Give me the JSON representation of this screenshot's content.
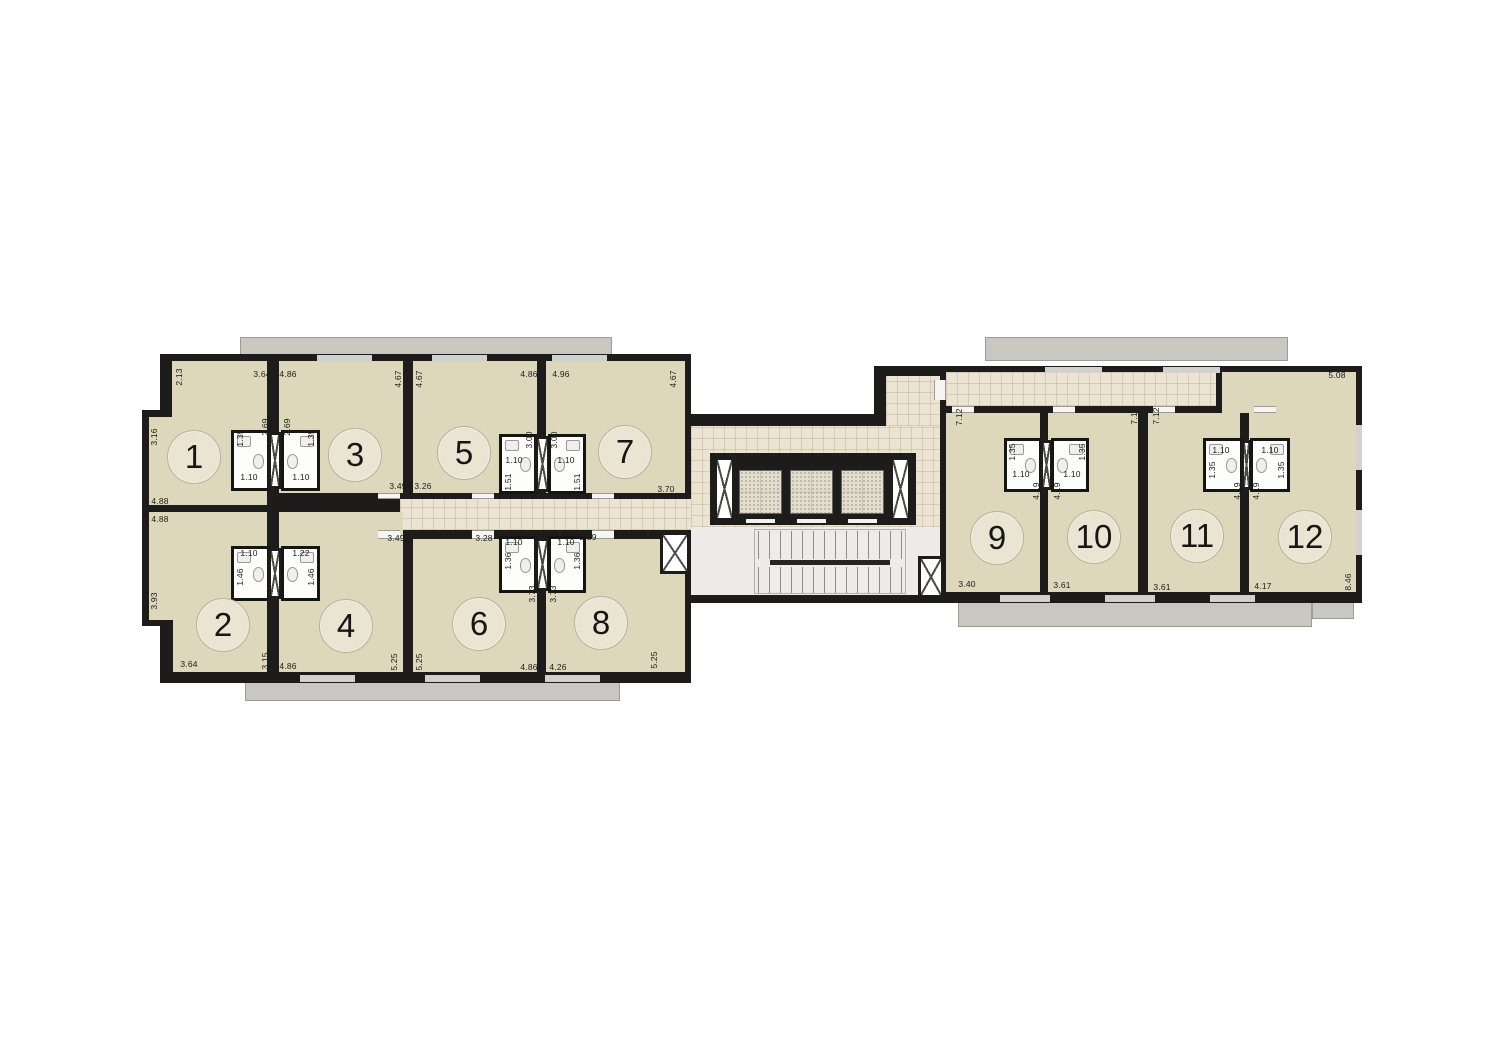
{
  "plan": {
    "name": "apartment-floor-plan",
    "colors": {
      "wall": "#1d1c1a",
      "room_fill": "#ddd7bc",
      "corridor_fill": "#ece4d3",
      "balcony_fill": "#c9c7c2",
      "stair_hall_fill": "#edecea",
      "bath_fill": "#fdfdfc",
      "background": "#ffffff"
    },
    "units": [
      {
        "n": "1",
        "x": 194,
        "y": 457
      },
      {
        "n": "2",
        "x": 223,
        "y": 625
      },
      {
        "n": "3",
        "x": 355,
        "y": 455
      },
      {
        "n": "4",
        "x": 346,
        "y": 626
      },
      {
        "n": "5",
        "x": 464,
        "y": 453
      },
      {
        "n": "6",
        "x": 479,
        "y": 624
      },
      {
        "n": "7",
        "x": 625,
        "y": 452
      },
      {
        "n": "8",
        "x": 601,
        "y": 623
      },
      {
        "n": "9",
        "x": 997,
        "y": 538
      },
      {
        "n": "10",
        "x": 1094,
        "y": 537
      },
      {
        "n": "11",
        "x": 1197,
        "y": 536
      },
      {
        "n": "12",
        "x": 1305,
        "y": 537
      }
    ],
    "dims": [
      {
        "t": "2.13",
        "x": 179,
        "y": 377,
        "v": 1
      },
      {
        "t": "3.64",
        "x": 262,
        "y": 374
      },
      {
        "t": "4.86",
        "x": 288,
        "y": 374
      },
      {
        "t": "4.67",
        "x": 398,
        "y": 379,
        "v": 1
      },
      {
        "t": "4.67",
        "x": 419,
        "y": 379,
        "v": 1
      },
      {
        "t": "4.86",
        "x": 529,
        "y": 374
      },
      {
        "t": "4.96",
        "x": 561,
        "y": 374
      },
      {
        "t": "4.67",
        "x": 673,
        "y": 379,
        "v": 1
      },
      {
        "t": "3.16",
        "x": 154,
        "y": 437,
        "v": 1
      },
      {
        "t": "4.88",
        "x": 160,
        "y": 501
      },
      {
        "t": "4.88",
        "x": 160,
        "y": 519
      },
      {
        "t": "3.93",
        "x": 154,
        "y": 601,
        "v": 1
      },
      {
        "t": "3.64",
        "x": 189,
        "y": 664
      },
      {
        "t": "3.15",
        "x": 265,
        "y": 661,
        "v": 1
      },
      {
        "t": "4.86",
        "x": 288,
        "y": 666
      },
      {
        "t": "5.25",
        "x": 394,
        "y": 662,
        "v": 1
      },
      {
        "t": "5.25",
        "x": 419,
        "y": 662,
        "v": 1
      },
      {
        "t": "4.86",
        "x": 529,
        "y": 667
      },
      {
        "t": "4.26",
        "x": 558,
        "y": 667
      },
      {
        "t": "5.25",
        "x": 654,
        "y": 660,
        "v": 1
      },
      {
        "t": "3.49",
        "x": 398,
        "y": 486
      },
      {
        "t": "3.26",
        "x": 423,
        "y": 486
      },
      {
        "t": "3.70",
        "x": 666,
        "y": 489
      },
      {
        "t": "3.49",
        "x": 396,
        "y": 538
      },
      {
        "t": "3.28",
        "x": 484,
        "y": 538
      },
      {
        "t": "2.89",
        "x": 588,
        "y": 537
      },
      {
        "t": "2.69",
        "x": 265,
        "y": 427,
        "v": 1
      },
      {
        "t": "2.69",
        "x": 287,
        "y": 427,
        "v": 1
      },
      {
        "t": "1.35",
        "x": 240,
        "y": 438,
        "v": 1
      },
      {
        "t": "1.10",
        "x": 249,
        "y": 477
      },
      {
        "t": "1.35",
        "x": 311,
        "y": 438,
        "v": 1
      },
      {
        "t": "1.10",
        "x": 301,
        "y": 477
      },
      {
        "t": "1.10",
        "x": 249,
        "y": 553
      },
      {
        "t": "1.46",
        "x": 240,
        "y": 577,
        "v": 1
      },
      {
        "t": "1.22",
        "x": 301,
        "y": 553
      },
      {
        "t": "1.46",
        "x": 311,
        "y": 577,
        "v": 1
      },
      {
        "t": "3.00",
        "x": 529,
        "y": 440,
        "v": 1
      },
      {
        "t": "3.00",
        "x": 554,
        "y": 440,
        "v": 1
      },
      {
        "t": "1.10",
        "x": 514,
        "y": 460
      },
      {
        "t": "1.51",
        "x": 508,
        "y": 482,
        "v": 1
      },
      {
        "t": "1.10",
        "x": 566,
        "y": 460
      },
      {
        "t": "1.51",
        "x": 577,
        "y": 482,
        "v": 1
      },
      {
        "t": "1.10",
        "x": 514,
        "y": 542
      },
      {
        "t": "1.36",
        "x": 508,
        "y": 561,
        "v": 1
      },
      {
        "t": "1.10",
        "x": 566,
        "y": 542
      },
      {
        "t": "1.36",
        "x": 577,
        "y": 561,
        "v": 1
      },
      {
        "t": "3.73",
        "x": 532,
        "y": 594,
        "v": 1
      },
      {
        "t": "3.73",
        "x": 553,
        "y": 594,
        "v": 1
      },
      {
        "t": "7.12",
        "x": 959,
        "y": 417,
        "v": 1
      },
      {
        "t": "7.12",
        "x": 1134,
        "y": 416,
        "v": 1
      },
      {
        "t": "7.12",
        "x": 1156,
        "y": 416,
        "v": 1
      },
      {
        "t": "5.08",
        "x": 1337,
        "y": 375
      },
      {
        "t": "1.35",
        "x": 1012,
        "y": 452,
        "v": 1
      },
      {
        "t": "1.10",
        "x": 1021,
        "y": 474
      },
      {
        "t": "1.35",
        "x": 1082,
        "y": 452,
        "v": 1
      },
      {
        "t": "1.10",
        "x": 1072,
        "y": 474
      },
      {
        "t": "4.19",
        "x": 1036,
        "y": 491,
        "v": 1
      },
      {
        "t": "4.19",
        "x": 1057,
        "y": 491,
        "v": 1
      },
      {
        "t": "1.10",
        "x": 1221,
        "y": 450
      },
      {
        "t": "1.35",
        "x": 1212,
        "y": 470,
        "v": 1
      },
      {
        "t": "1.10",
        "x": 1270,
        "y": 450
      },
      {
        "t": "1.35",
        "x": 1281,
        "y": 470,
        "v": 1
      },
      {
        "t": "4.19",
        "x": 1237,
        "y": 491,
        "v": 1
      },
      {
        "t": "4.19",
        "x": 1256,
        "y": 491,
        "v": 1
      },
      {
        "t": "3.40",
        "x": 967,
        "y": 584
      },
      {
        "t": "3.61",
        "x": 1062,
        "y": 585
      },
      {
        "t": "3.61",
        "x": 1162,
        "y": 587
      },
      {
        "t": "4.17",
        "x": 1263,
        "y": 586
      },
      {
        "t": "8.46",
        "x": 1348,
        "y": 582,
        "v": 1
      }
    ]
  }
}
